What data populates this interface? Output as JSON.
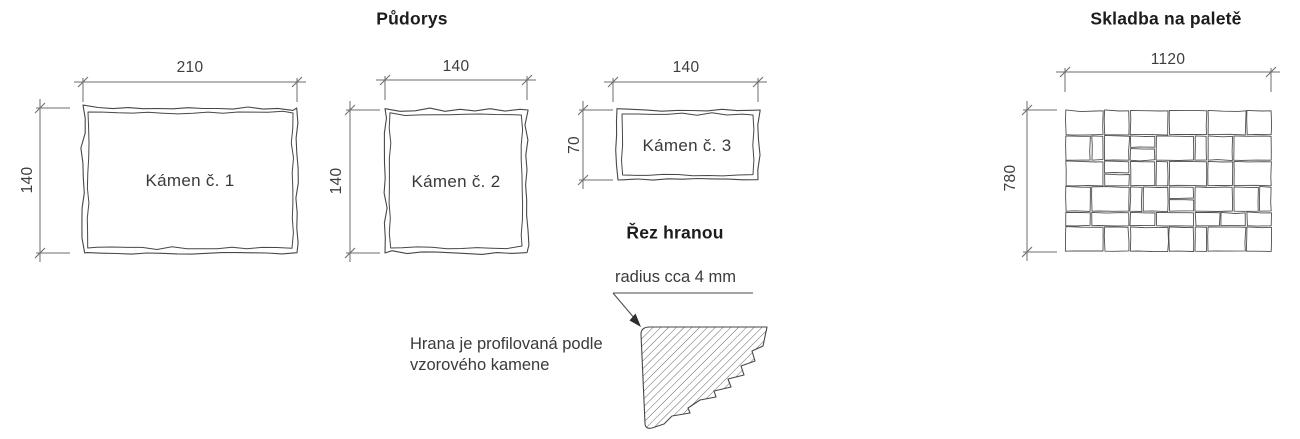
{
  "titles": {
    "plan": "Půdorys",
    "pallet": "Skladba na paletě",
    "edge_section": "Řez hranou"
  },
  "stones": [
    {
      "label": "Kámen č. 1",
      "width_mm": "210",
      "height_mm": "140"
    },
    {
      "label": "Kámen č. 2",
      "width_mm": "140",
      "height_mm": "140"
    },
    {
      "label": "Kámen č. 3",
      "width_mm": "140",
      "height_mm": "70"
    }
  ],
  "edge_detail": {
    "radius_note": "radius cca 4 mm",
    "description_line1": "Hrana je profilovaná podle",
    "description_line2": "vzorového kamene"
  },
  "pallet": {
    "width_mm": "1120",
    "height_mm": "780",
    "stones_mm": [
      [
        0,
        0,
        210,
        140
      ],
      [
        210,
        0,
        140,
        140
      ],
      [
        350,
        0,
        210,
        140
      ],
      [
        560,
        0,
        210,
        140
      ],
      [
        770,
        0,
        210,
        140
      ],
      [
        980,
        0,
        140,
        140
      ],
      [
        0,
        140,
        140,
        140
      ],
      [
        140,
        140,
        70,
        140
      ],
      [
        210,
        140,
        140,
        140
      ],
      [
        350,
        140,
        140,
        70
      ],
      [
        350,
        210,
        140,
        70
      ],
      [
        490,
        140,
        210,
        140
      ],
      [
        700,
        140,
        70,
        140
      ],
      [
        770,
        140,
        140,
        140
      ],
      [
        910,
        140,
        210,
        140
      ],
      [
        0,
        280,
        210,
        140
      ],
      [
        210,
        280,
        140,
        70
      ],
      [
        210,
        350,
        140,
        70
      ],
      [
        350,
        280,
        140,
        140
      ],
      [
        490,
        280,
        70,
        140
      ],
      [
        560,
        280,
        210,
        140
      ],
      [
        770,
        280,
        140,
        140
      ],
      [
        910,
        280,
        210,
        140
      ],
      [
        0,
        420,
        140,
        140
      ],
      [
        140,
        420,
        210,
        140
      ],
      [
        350,
        420,
        70,
        140
      ],
      [
        420,
        420,
        140,
        140
      ],
      [
        560,
        420,
        140,
        70
      ],
      [
        560,
        490,
        140,
        70
      ],
      [
        700,
        420,
        210,
        140
      ],
      [
        910,
        420,
        140,
        140
      ],
      [
        1050,
        420,
        70,
        140
      ],
      [
        0,
        560,
        140,
        80
      ],
      [
        140,
        560,
        210,
        80
      ],
      [
        350,
        560,
        140,
        80
      ],
      [
        490,
        560,
        210,
        80
      ],
      [
        700,
        560,
        140,
        80
      ],
      [
        840,
        560,
        140,
        80
      ],
      [
        980,
        560,
        140,
        80
      ],
      [
        0,
        640,
        210,
        140
      ],
      [
        210,
        640,
        140,
        140
      ],
      [
        350,
        640,
        210,
        140
      ],
      [
        560,
        640,
        140,
        140
      ],
      [
        700,
        640,
        70,
        140
      ],
      [
        770,
        640,
        210,
        140
      ],
      [
        980,
        640,
        140,
        140
      ]
    ]
  },
  "colors": {
    "stone_outline": "#474747",
    "dimension_line": "#6e6e6e",
    "hatch_line": "#555555",
    "text": "#3a3a3a"
  }
}
